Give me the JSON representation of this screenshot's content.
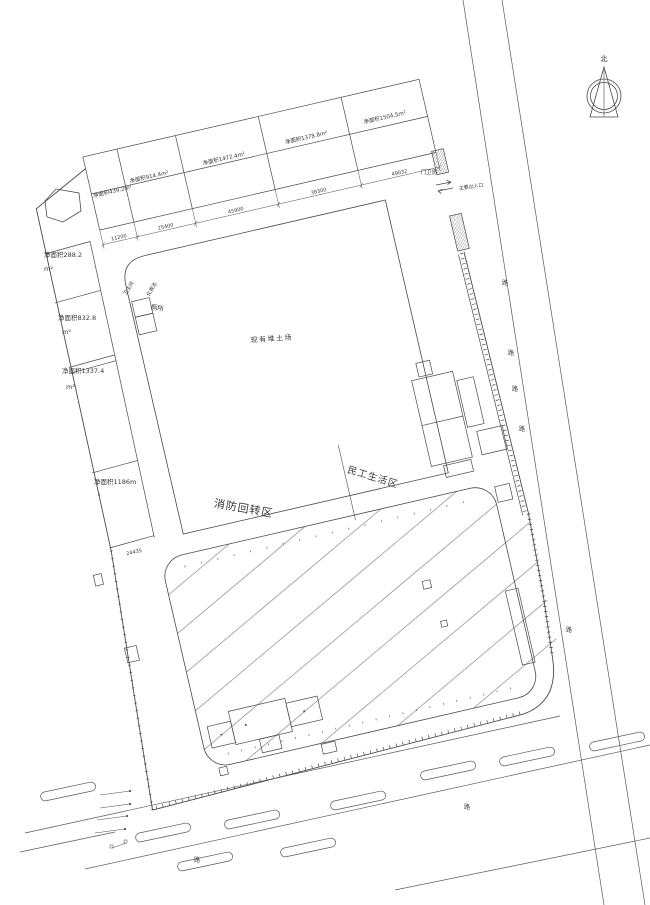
{
  "north": {
    "label": "北"
  },
  "top_parcels": [
    {
      "label": "净面积439.2m²"
    },
    {
      "label": "净面积914.4m²"
    },
    {
      "label": "净面积1472.4m²"
    },
    {
      "label": "净面积1378.8m²"
    },
    {
      "label": "净面积1504.5m²"
    }
  ],
  "top_dims": [
    "11200",
    "25400",
    "45900",
    "38300",
    "49032"
  ],
  "left_parcels": [
    {
      "area": "净面积288.2",
      "unit": "m²"
    },
    {
      "area": "净面积832.8",
      "unit": "m²"
    },
    {
      "area": "净面积1337.4",
      "unit": "m²"
    },
    {
      "area": "净面积1186m",
      "unit": "²"
    }
  ],
  "left_dim": "24435",
  "zones": {
    "soil_yard": "现有堆土场",
    "fire_turnaround": "消防回转区",
    "workers_living": "民工生活区",
    "toilet": "厕所",
    "washroom": "卫生间",
    "septic_tank": "化粪池",
    "guard_house": "门卫房",
    "main_entrance": "主要出入口"
  },
  "road_labels": {
    "east": [
      "路",
      "路",
      "路",
      "路",
      "路"
    ],
    "south": [
      "路",
      "路"
    ]
  },
  "colors": {
    "line": "#4a4a4a",
    "hatch": "#9a9a9a",
    "text": "#3a3a3a",
    "background": "#ffffff"
  }
}
